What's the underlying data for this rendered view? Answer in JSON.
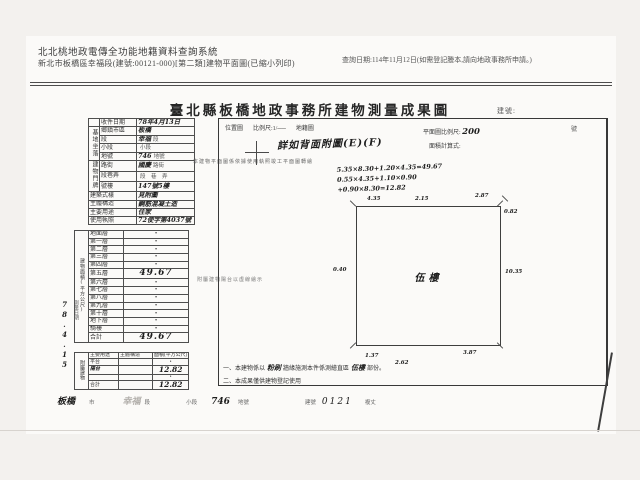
{
  "header": {
    "system_title": "北北桃地政電傳全功能地籍資料查詢系統",
    "system_subtitle": "新北市板橋區幸福段(建號:00121-000)[第二類]建物平面圖(已縮小列印)",
    "query_date": "查詢日期:114年11月12日(如需登記謄本,請向地政事務所申請。)"
  },
  "doc": {
    "title": "臺北縣板橋地政事務所建物測量成果圖",
    "doc_no_label": "建號:",
    "intake_label": "收件日期",
    "intake_value": "78年4月13日",
    "site_group": "基地坐落",
    "site_rows": [
      {
        "label": "鄉鎮市區",
        "hand": "板橋",
        "print": ""
      },
      {
        "label": "段",
        "hand": "幸福",
        "print": "段"
      },
      {
        "label": "小段",
        "hand": "",
        "print": "小段"
      },
      {
        "label": "地號",
        "hand": "746",
        "print": "地號"
      }
    ],
    "addr_group": "建物門牌",
    "addr_rows": [
      {
        "label": "路街",
        "hand": "國慶",
        "print": "路街"
      },
      {
        "label": "段巷弄",
        "hand": "",
        "print": "段　巷　弄"
      },
      {
        "label": "號樓",
        "hand": "147號5樓",
        "print": ""
      }
    ],
    "attr_rows": [
      {
        "label": "建築式樣",
        "hand": "見附圖"
      },
      {
        "label": "主體構造",
        "hand": "鋼筋混凝土造"
      },
      {
        "label": "主要用途",
        "hand": "住家"
      },
      {
        "label": "使用執照",
        "hand": "72使字第4037號"
      }
    ],
    "floor_group": "建物面積(平方公尺)",
    "floor_rows": [
      {
        "label": "地面層",
        "value": "•"
      },
      {
        "label": "第一層",
        "value": "•"
      },
      {
        "label": "第二層",
        "value": "•"
      },
      {
        "label": "第三層",
        "value": "•"
      },
      {
        "label": "第四層",
        "value": "•"
      },
      {
        "label": "第五層",
        "value": "49.67"
      },
      {
        "label": "第六層",
        "value": "•"
      },
      {
        "label": "第七層",
        "value": "•"
      },
      {
        "label": "第八層",
        "value": "•"
      },
      {
        "label": "第九層",
        "value": "•"
      },
      {
        "label": "第十層",
        "value": "•"
      },
      {
        "label": "地下層",
        "value": "•"
      },
      {
        "label": "騎樓",
        "value": "•"
      },
      {
        "label": "合計",
        "value": "49.67"
      }
    ],
    "attach_group": "附屬建物",
    "attach_header": [
      "主要用途",
      "主體構造",
      "面積(平方公尺)"
    ],
    "attach_rows": [
      {
        "use": "平台",
        "structure": "",
        "area": "•"
      },
      {
        "use": "陽台",
        "structure": "",
        "area": "12.82"
      },
      {
        "use": "",
        "structure": "",
        "area": "•"
      },
      {
        "use": "合計",
        "structure": "",
        "area": "12.82"
      }
    ],
    "survey_label": "測量日期",
    "survey_date": "78.4.15",
    "side_note_1": "本建物平面圖係依據使用執照竣工平面圖轉繪",
    "side_note_2": "附屬建物陽台以虛線繪示",
    "drawing": {
      "location_label": "位置圖",
      "location_scale": "比例尺:1/──",
      "cadastral_label": "地籍圖",
      "no_label": "號",
      "ref_note": "詳如背面附圖(E)(F)",
      "plan_scale_label": "平面圖比例尺:",
      "plan_scale_value": "200",
      "calc_label": "面積計算式:",
      "calc_line_1": "5.35×8.30+1.20×4.35=49.67",
      "calc_line_2": "0.55×4.35+1.10×0.90",
      "calc_line_3": "+0.90×8.30=12.82",
      "room_label": "伍樓",
      "dims": [
        "4.35",
        "2.15",
        "2.87",
        "0.82",
        "10.35",
        "0.40",
        "1.37",
        "2.62",
        "3.87"
      ]
    },
    "note_1": {
      "prefix": "一、本建物係以",
      "hand_a": "粉刷",
      "mid": "牆緣施測本件係測繪直區",
      "hand_b": "伍樓",
      "suffix": "部份。"
    },
    "note_2": "二、本成果僅供建物登記使用",
    "footer": {
      "city_hand": "板橋",
      "city_label": "市",
      "sec_hand": "幸福",
      "sec_label": "段",
      "subsec_label": "小段",
      "lot_hand": "746",
      "lot_label": "地號",
      "bno_label": "建號",
      "bno_value": "0121",
      "end_label": "複丈"
    }
  }
}
